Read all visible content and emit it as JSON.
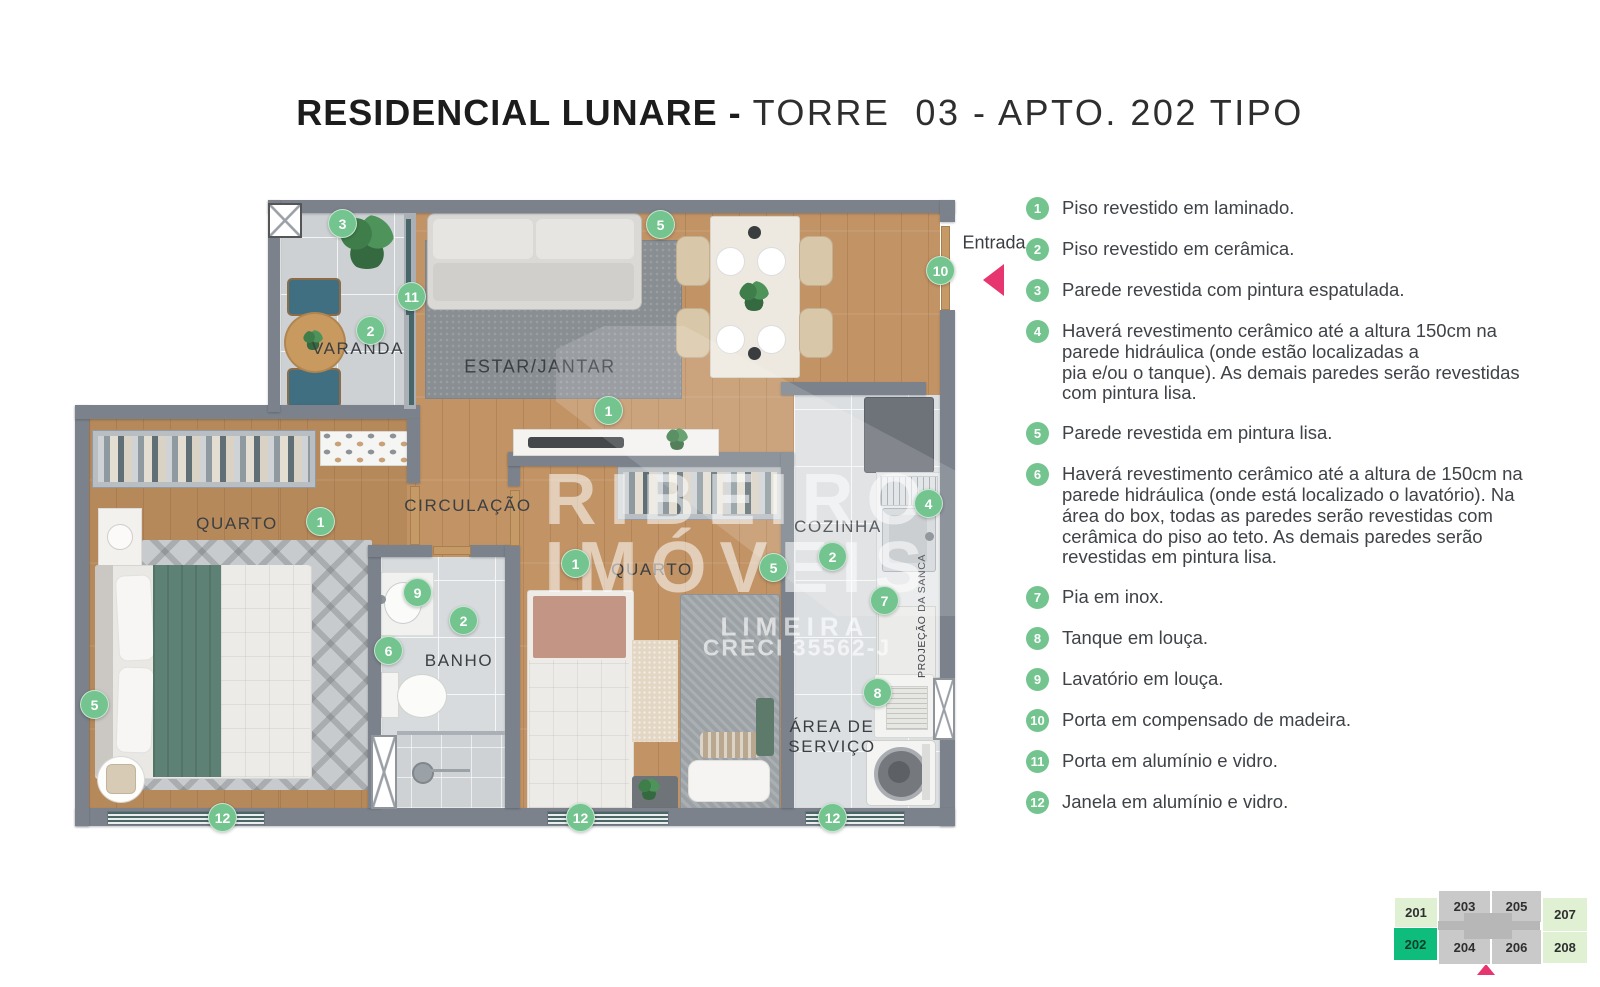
{
  "title": {
    "project": "RESIDENCIAL LUNARE - ",
    "unit": "TORRE  03 - APTO. 202 TIPO"
  },
  "entrance": {
    "label": "Entrada"
  },
  "rooms": [
    {
      "id": "varanda",
      "label": "VARANDA"
    },
    {
      "id": "estar_jantar",
      "label": "ESTAR/JANTAR"
    },
    {
      "id": "circulacao",
      "label": "CIRCULAÇÃO"
    },
    {
      "id": "quarto_1",
      "label": "QUARTO"
    },
    {
      "id": "banho",
      "label": "BANHO"
    },
    {
      "id": "quarto_2",
      "label": "QUARTO"
    },
    {
      "id": "cozinha",
      "label": "COZINHA"
    },
    {
      "id": "area_servico",
      "label": "ÁREA DE\nSERVIÇO"
    }
  ],
  "sanca_label": "PROJEÇÃO DA SANCA",
  "plan_badges": [
    {
      "n": "3",
      "x": 342,
      "y": 223
    },
    {
      "n": "5",
      "x": 660,
      "y": 224
    },
    {
      "n": "10",
      "x": 940,
      "y": 270
    },
    {
      "n": "11",
      "x": 411,
      "y": 296
    },
    {
      "n": "2",
      "x": 370,
      "y": 330
    },
    {
      "n": "1",
      "x": 608,
      "y": 410
    },
    {
      "n": "1",
      "x": 320,
      "y": 521
    },
    {
      "n": "9",
      "x": 417,
      "y": 592
    },
    {
      "n": "2",
      "x": 463,
      "y": 620
    },
    {
      "n": "6",
      "x": 388,
      "y": 650
    },
    {
      "n": "5",
      "x": 94,
      "y": 704
    },
    {
      "n": "1",
      "x": 575,
      "y": 563
    },
    {
      "n": "5",
      "x": 773,
      "y": 567
    },
    {
      "n": "2",
      "x": 832,
      "y": 556
    },
    {
      "n": "4",
      "x": 928,
      "y": 503
    },
    {
      "n": "7",
      "x": 884,
      "y": 600
    },
    {
      "n": "8",
      "x": 877,
      "y": 692
    },
    {
      "n": "12",
      "x": 222,
      "y": 817
    },
    {
      "n": "12",
      "x": 580,
      "y": 817
    },
    {
      "n": "12",
      "x": 832,
      "y": 817
    }
  ],
  "legend": [
    {
      "n": "1",
      "text": "Piso revestido em laminado."
    },
    {
      "n": "2",
      "text": "Piso revestido em cerâmica."
    },
    {
      "n": "3",
      "text": "Parede revestida com pintura espatulada."
    },
    {
      "n": "4",
      "text": "Haverá revestimento cerâmico até a altura 150cm na\nparede hidráulica (onde estão localizadas a\npia e/ou o tanque). As demais paredes serão revestidas\ncom pintura lisa."
    },
    {
      "n": "5",
      "text": "Parede revestida em pintura lisa."
    },
    {
      "n": "6",
      "text": "Haverá revestimento cerâmico até a altura de 150cm na\nparede hidráulica (onde está localizado o lavatório). Na\nárea do box, todas as paredes serão revestidas com\ncerâmica do piso ao teto. As demais paredes serão\nrevestidas em pintura lisa."
    },
    {
      "n": "7",
      "text": "Pia em inox."
    },
    {
      "n": "8",
      "text": "Tanque em louça."
    },
    {
      "n": "9",
      "text": "Lavatório em louça."
    },
    {
      "n": "10",
      "text": "Porta em compensado de madeira."
    },
    {
      "n": "11",
      "text": "Porta em alumínio e vidro."
    },
    {
      "n": "12",
      "text": "Janela em alumínio e vidro."
    }
  ],
  "watermark": {
    "brand_top": "RIBEIRO",
    "brand_bottom": "IMÓVEIS",
    "city": "LIMEIRA",
    "creci": "CRECI 35562-J"
  },
  "keyplan": {
    "highlight": "202",
    "units": [
      {
        "num": "201",
        "type": "green-light"
      },
      {
        "num": "202",
        "type": "green-bright"
      },
      {
        "num": "203",
        "type": "gray"
      },
      {
        "num": "204",
        "type": "gray"
      },
      {
        "num": "205",
        "type": "gray"
      },
      {
        "num": "206",
        "type": "gray"
      },
      {
        "num": "207",
        "type": "green-light"
      },
      {
        "num": "208",
        "type": "green-light"
      }
    ]
  },
  "colors": {
    "badge_green": "#73c48e",
    "accent_pink": "#e7356f",
    "wall_gray": "#7b828b",
    "keyplan_highlight": "#0ebd7c",
    "keyplan_green_light": "#dff0d3"
  }
}
